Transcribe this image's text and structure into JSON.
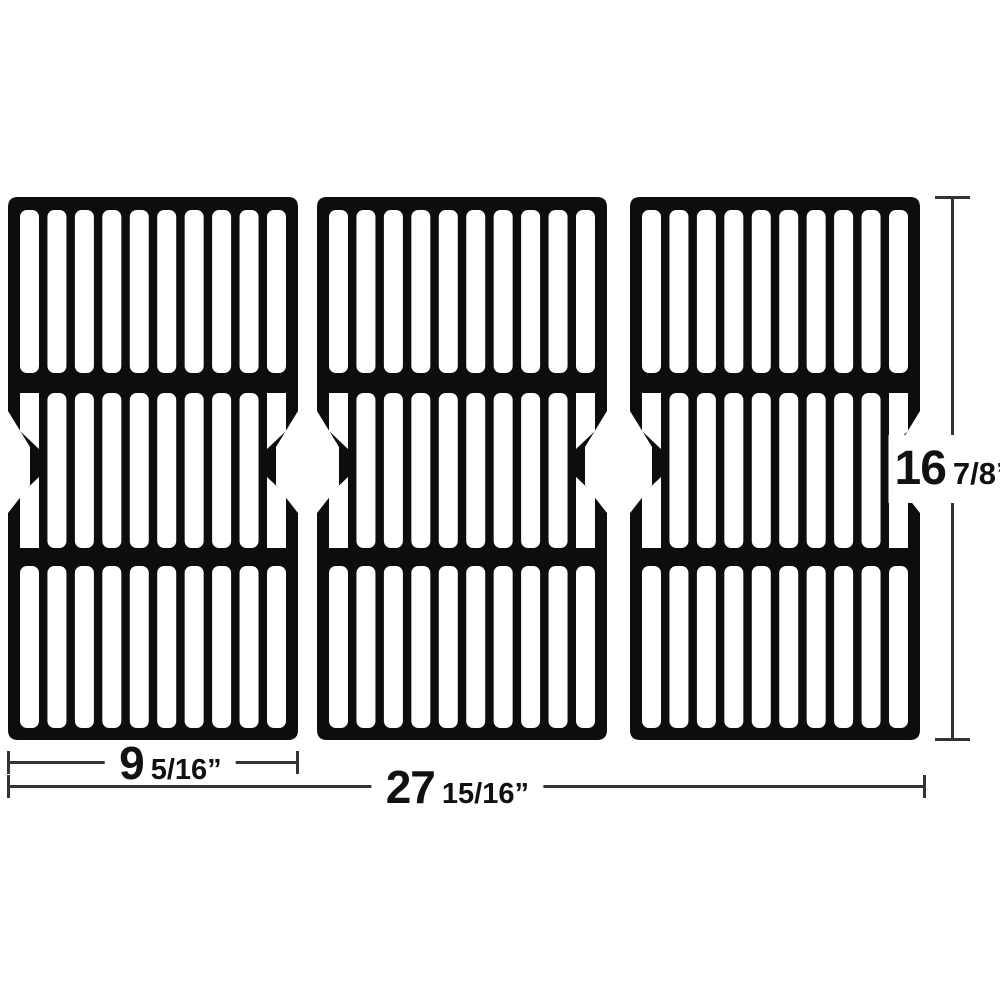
{
  "colors": {
    "background": "#ffffff",
    "grate": "#0d0d0d",
    "dimension_line": "#333333",
    "text": "#111111"
  },
  "panels": {
    "count": 3
  },
  "dimensions": {
    "panel_width": {
      "whole": "9",
      "fraction": "5/16”"
    },
    "total_width": {
      "whole": "27",
      "fraction": "15/16”"
    },
    "height": {
      "whole": "16",
      "fraction": "7/8”"
    }
  }
}
